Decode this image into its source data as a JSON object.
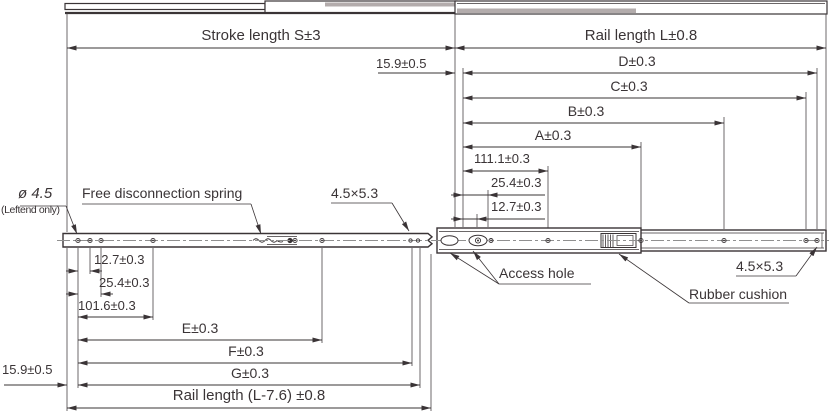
{
  "drawing_title": "Telescopic drawer slide rail dimension drawing",
  "dims_top": {
    "stroke": "Stroke length S±3",
    "rail": "Rail length L±0.8",
    "offset": "15.9±0.5",
    "d": "D±0.3",
    "c": "C±0.3",
    "b": "B±0.3",
    "a": "A±0.3",
    "h111": "111.1±0.3",
    "h254": "25.4±0.3",
    "h127": "12.7±0.3"
  },
  "dims_bottom": {
    "h127": "12.7±0.3",
    "h254": "25.4±0.3",
    "h1016": "101.6±0.3",
    "e": "E±0.3",
    "f": "F±0.3",
    "g": "G±0.3",
    "offset": "15.9±0.5",
    "rail": "Rail length (L-7.6) ±0.8"
  },
  "callouts": {
    "hole_dia": "ø 4.5",
    "hole_dia_note": "(Leftend only)",
    "spring": "Free disconnection spring",
    "slot_mid": "4.5×5.3",
    "access": "Access hole",
    "cushion": "Rubber cushion",
    "slot_right": "4.5×5.3"
  },
  "colors": {
    "line": "#3a3436",
    "centerline": "#909090",
    "background": "#ffffff"
  }
}
